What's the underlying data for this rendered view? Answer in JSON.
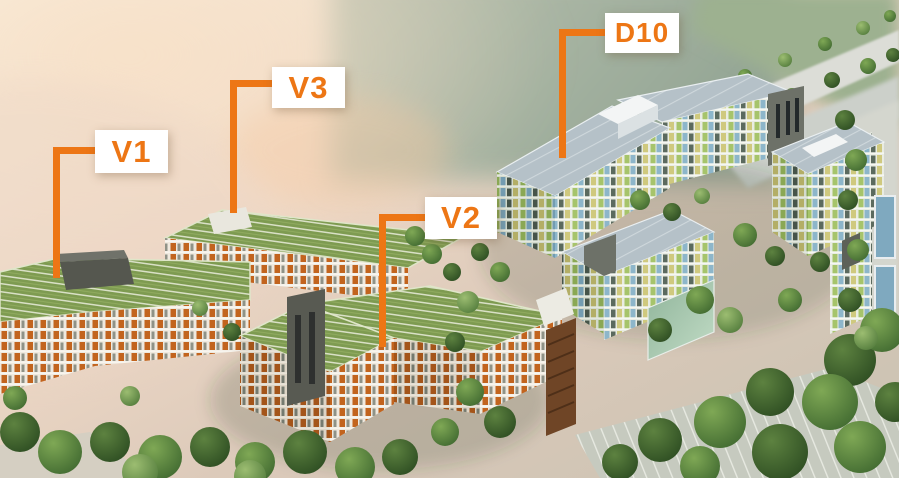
{
  "scene": {
    "type": "aerial-3d-architectural-rendering",
    "description": "Bird's-eye 3D rendering of a green-roofed residential complex beside hazy water; orange callout labels mark buildings V1, V3, V2 and D10.",
    "accent_color": "#ed7615",
    "label_background": "#ffffff"
  },
  "labels": [
    {
      "text": "V1"
    },
    {
      "text": "V3"
    },
    {
      "text": "V2"
    },
    {
      "text": "D10"
    }
  ]
}
